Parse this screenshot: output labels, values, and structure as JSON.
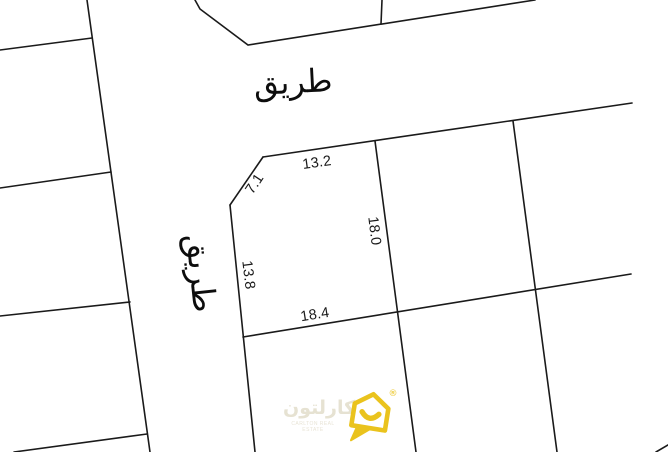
{
  "roads": {
    "top_label": "طريق",
    "left_label": "طريق"
  },
  "parcel_dimensions": {
    "top": "13.2",
    "chamfer": "7.1",
    "east": "18.0",
    "west": "13.8",
    "south": "18.4"
  },
  "watermark": {
    "name_arabic": "كارلتون",
    "name_english": "CARLTON REAL ESTATE",
    "registered": "®",
    "brand_yellow": "#eac31d",
    "text_light": "#e3e0d2"
  },
  "canvas": {
    "background": "#ffffff",
    "line_color": "#1a1a1a"
  }
}
